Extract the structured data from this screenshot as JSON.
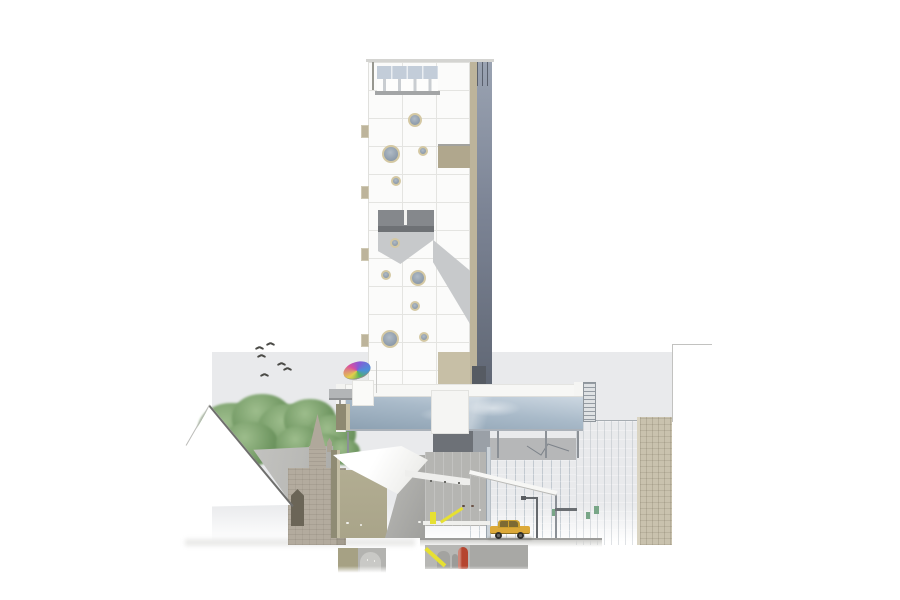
{
  "colors": {
    "page_bg": "#ffffff",
    "backdrop": "#e9eaec",
    "outline": "#c2c2c0",
    "tower_panel": "#fbfbfa",
    "tower_grid": "#e4e4e1",
    "tower_tan": "#bdb49b",
    "tower_tan_dark": "#b0a78d",
    "glazing_top": "#9aa3b2",
    "glazing_mid": "#7c8495",
    "glazing_dark": "#5f6673",
    "sawtooth_glass": "#c3cdd9",
    "sawtooth_base": "#a3a5a6",
    "balcony": "#85888c",
    "balcony_dark": "#6e7175",
    "facade_shadow": "#c7c9cb",
    "porthole_ring": "#d4c8a3",
    "porthole_glass": "#8b99a8",
    "bridge_white": "#f7f7f5",
    "bridge_glass_top": "#ccd7e1",
    "bridge_glass_bot": "#8da1b2",
    "ladder": "#dfe2e4",
    "ladder_line": "#949ba2",
    "column": "#8b9096",
    "tree_light": "#9dbd8c",
    "tree_dark": "#6f9661",
    "roof_gray": "#b9b9b6",
    "roofline": "#6f6f6d",
    "church_stone": "#b3ab9e",
    "church_window": "#6b6557",
    "canopy_white": "#fbfbf9",
    "canopy_shade": "#e6e6e2",
    "olive_wall": "#8f8b74",
    "olive_room": "#a9a489",
    "concrete": "#b5b5b2",
    "concrete_dark": "#9f9f9c",
    "glassA_top": "#c3cfda",
    "glassA_bot": "#a9bac7",
    "glassB": "#c9d1d8",
    "tan_building": "#c9c2ae",
    "street": "#9c9c9a",
    "taxi_body": "#dca939",
    "taxi_dark": "#7c6a33",
    "wheel": "#2e2e2c",
    "stairs_yellow": "#e6e032",
    "tank_red": "#b5452e",
    "cylinder": "#a3a3a0",
    "figure_light": "#f0f0ec",
    "figure_dark1": "#5d4a42",
    "figure_dark2": "#6b5347",
    "sign_green": "#78a687",
    "lamp": "#64686c",
    "arch_fill": "#c9c9c6",
    "u1": "#d94fa0",
    "u2": "#8a57d6",
    "u3": "#4a90d9",
    "u4": "#57b457",
    "u5": "#e3cf4a"
  },
  "portholes": [
    {
      "x": 417,
      "y": 122,
      "r": 7
    },
    {
      "x": 393,
      "y": 156,
      "r": 9
    },
    {
      "x": 425,
      "y": 153,
      "r": 5
    },
    {
      "x": 398,
      "y": 183,
      "r": 5
    },
    {
      "x": 397,
      "y": 245,
      "r": 5
    },
    {
      "x": 388,
      "y": 277,
      "r": 5
    },
    {
      "x": 420,
      "y": 280,
      "r": 8
    },
    {
      "x": 417,
      "y": 308,
      "r": 5
    },
    {
      "x": 392,
      "y": 341,
      "r": 9
    },
    {
      "x": 426,
      "y": 339,
      "r": 5
    },
    {
      "x": 450,
      "y": 411,
      "r": 12
    }
  ],
  "birds": [
    {
      "x": 255,
      "y": 345
    },
    {
      "x": 266,
      "y": 341
    },
    {
      "x": 257,
      "y": 353
    },
    {
      "x": 277,
      "y": 361
    },
    {
      "x": 283,
      "y": 366
    },
    {
      "x": 260,
      "y": 372
    }
  ],
  "trees": [
    {
      "x": 232,
      "y": 430,
      "r": 34
    },
    {
      "x": 262,
      "y": 418,
      "r": 30
    },
    {
      "x": 288,
      "y": 428,
      "r": 30
    },
    {
      "x": 310,
      "y": 420,
      "r": 26
    },
    {
      "x": 332,
      "y": 434,
      "r": 24
    },
    {
      "x": 218,
      "y": 448,
      "r": 24
    },
    {
      "x": 250,
      "y": 444,
      "r": 28
    },
    {
      "x": 300,
      "y": 445,
      "r": 24
    },
    {
      "x": 325,
      "y": 450,
      "r": 20
    },
    {
      "x": 344,
      "y": 452,
      "r": 16
    }
  ],
  "tower_tabs": [
    125,
    186,
    248,
    334
  ],
  "support_columns": [
    {
      "x": 347,
      "y": 432,
      "h": 30
    },
    {
      "x": 497,
      "y": 430,
      "h": 28
    },
    {
      "x": 545,
      "y": 430,
      "h": 28
    },
    {
      "x": 577,
      "y": 422,
      "h": 36
    },
    {
      "x": 555,
      "y": 492,
      "h": 46
    }
  ],
  "figures": [
    {
      "x": 344,
      "y": 522,
      "h": 16,
      "c": "figure_light"
    },
    {
      "x": 358,
      "y": 524,
      "h": 14,
      "c": "figure_light"
    },
    {
      "x": 416,
      "y": 521,
      "h": 17,
      "c": "figure_light"
    },
    {
      "x": 477,
      "y": 509,
      "h": 14,
      "c": "figure_light"
    },
    {
      "x": 460,
      "y": 505,
      "h": 17,
      "c": "figure_dark1"
    },
    {
      "x": 469,
      "y": 505,
      "h": 17,
      "c": "figure_dark2"
    },
    {
      "x": 365,
      "y": 559,
      "h": 12,
      "c": "figure_light"
    },
    {
      "x": 372,
      "y": 560,
      "h": 11,
      "c": "figure_light"
    }
  ],
  "exit_signs": [
    {
      "x": 552,
      "y": 509,
      "w": 5,
      "h": 7
    },
    {
      "x": 594,
      "y": 506,
      "w": 5,
      "h": 8
    },
    {
      "x": 586,
      "y": 512,
      "w": 4,
      "h": 7
    }
  ],
  "ceiling_lights": [
    {
      "x": 430,
      "y": 480
    },
    {
      "x": 444,
      "y": 481
    },
    {
      "x": 458,
      "y": 482
    }
  ]
}
